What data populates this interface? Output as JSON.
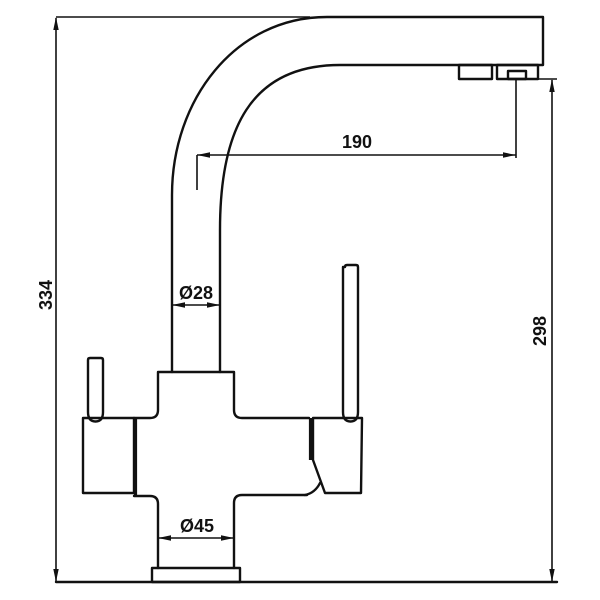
{
  "drawing": {
    "type": "technical-dimension-drawing",
    "subject": "kitchen-faucet-side-view",
    "colors": {
      "line": "#111111",
      "background": "#ffffff"
    },
    "dimensions": {
      "total_height": "334",
      "spout_reach": "190",
      "outlet_height": "298",
      "riser_diameter": "Ø28",
      "base_diameter": "Ø45"
    }
  }
}
